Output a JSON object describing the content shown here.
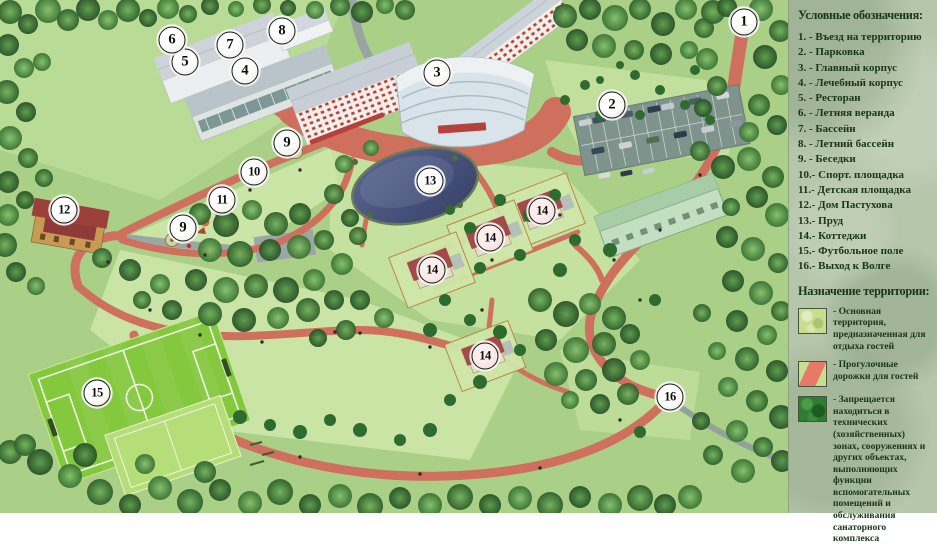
{
  "theme": {
    "path_red": "#cf6f5e",
    "grass_green": "#aed489",
    "forest_green": "#3c7438",
    "pond_blue": "#47547e",
    "legend_bg": "#b6c6ab",
    "legend_text": "#17361b",
    "stripe_red": "#e87868",
    "restricted_green": "#2e7d32",
    "territory_green": "#c8dd8e",
    "marker_fill": "#faf8f0",
    "marker_border": "#1a1a1a",
    "cottage_roof": "#a14e4a",
    "field_green": "#84c83d"
  },
  "legend": {
    "title": "Условные обозначения:",
    "items": [
      {
        "text": "1. - Въезд на территорию"
      },
      {
        "text": "2. - Парковка"
      },
      {
        "text": "3. - Главный корпус"
      },
      {
        "text": "4. - Лечебный корпус"
      },
      {
        "text": "5. - Ресторан"
      },
      {
        "text": "6. - Летняя веранда"
      },
      {
        "text": "7. - Бассейн"
      },
      {
        "text": "8. - Летний бассейн"
      },
      {
        "text": "9. - Беседки"
      },
      {
        "text": "10.- Спорт. площадка"
      },
      {
        "text": "11.- Детская площадка"
      },
      {
        "text": "12.- Дом Пастухова"
      },
      {
        "text": "13.- Пруд"
      },
      {
        "text": "14.- Коттеджи"
      },
      {
        "text": "15.- Футбольное поле"
      },
      {
        "text": "16.- Выход к Волге"
      }
    ]
  },
  "territory": {
    "title": "Назначение территории:",
    "entries": [
      {
        "swatch": "main-territory",
        "label": "- Основная территория, предназначенная для отдыха гостей"
      },
      {
        "swatch": "walking-paths",
        "label": "- Прогулочные дорожки для гостей"
      },
      {
        "swatch": "restricted-zones",
        "label": "- Запрещается находиться в технических (хозяйственных) зонах, сооружениях и других объектах, выполняющих функции вспомогательных помещений и обслуживания санаторного комплекса"
      }
    ]
  },
  "map": {
    "markers": [
      {
        "label": "1",
        "x": 744,
        "y": 22
      },
      {
        "label": "2",
        "x": 612,
        "y": 105
      },
      {
        "label": "3",
        "x": 437,
        "y": 73
      },
      {
        "label": "4",
        "x": 245,
        "y": 71
      },
      {
        "label": "5",
        "x": 185,
        "y": 62
      },
      {
        "label": "6",
        "x": 172,
        "y": 40
      },
      {
        "label": "7",
        "x": 230,
        "y": 45
      },
      {
        "label": "8",
        "x": 282,
        "y": 31
      },
      {
        "label": "9",
        "x": 287,
        "y": 143
      },
      {
        "label": "10",
        "x": 254,
        "y": 172
      },
      {
        "label": "11",
        "x": 222,
        "y": 200
      },
      {
        "label": "9",
        "x": 183,
        "y": 228
      },
      {
        "label": "12",
        "x": 64,
        "y": 210
      },
      {
        "label": "13",
        "x": 430,
        "y": 181
      },
      {
        "label": "14",
        "x": 542,
        "y": 211,
        "tint": "#f3d8d8"
      },
      {
        "label": "14",
        "x": 490,
        "y": 238,
        "tint": "#f3d8d8"
      },
      {
        "label": "14",
        "x": 432,
        "y": 270,
        "tint": "#f3d8d8"
      },
      {
        "label": "14",
        "x": 485,
        "y": 356,
        "tint": "#f3d8d8"
      },
      {
        "label": "15",
        "x": 97,
        "y": 393
      },
      {
        "label": "16",
        "x": 670,
        "y": 397
      }
    ]
  }
}
